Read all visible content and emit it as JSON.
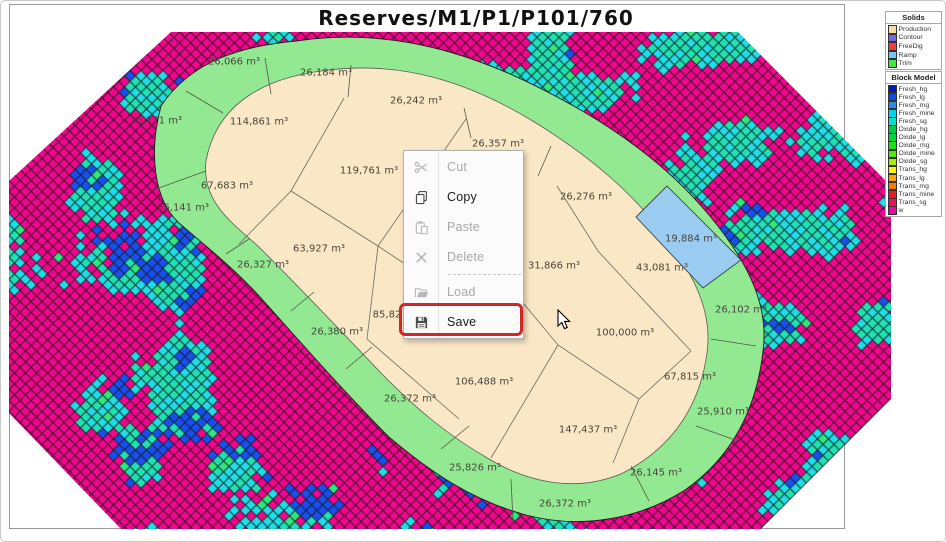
{
  "window": {
    "title": "Reserves/M1/P1/P101/760"
  },
  "map": {
    "volume_labels": [
      {
        "text": "26,066 m³",
        "x": 233,
        "y": 61
      },
      {
        "text": "26,184 m³",
        "x": 325,
        "y": 72
      },
      {
        "text": "26,242 m³",
        "x": 415,
        "y": 100
      },
      {
        "text": "26,357 m³",
        "x": 497,
        "y": 143
      },
      {
        "text": "25,771 m³",
        "x": 155,
        "y": 120
      },
      {
        "text": "114,861 m³",
        "x": 258,
        "y": 121
      },
      {
        "text": "119,761 m³",
        "x": 368,
        "y": 170
      },
      {
        "text": "67,683 m³",
        "x": 226,
        "y": 185
      },
      {
        "text": "26,141 m³",
        "x": 182,
        "y": 207
      },
      {
        "text": "63,927 m³",
        "x": 318,
        "y": 248
      },
      {
        "text": "26,327 m³",
        "x": 262,
        "y": 264
      },
      {
        "text": "26,276 m³",
        "x": 585,
        "y": 196
      },
      {
        "text": "19,884 m³",
        "x": 690,
        "y": 238
      },
      {
        "text": "31,866 m³",
        "x": 553,
        "y": 265
      },
      {
        "text": "43,081 m³",
        "x": 661,
        "y": 267
      },
      {
        "text": "26,102 m³",
        "x": 740,
        "y": 309
      },
      {
        "text": "100,000 m³",
        "x": 624,
        "y": 332
      },
      {
        "text": "85,82",
        "x": 386,
        "y": 314
      },
      {
        "text": "26,380 m³",
        "x": 336,
        "y": 331
      },
      {
        "text": "106,488 m³",
        "x": 483,
        "y": 381
      },
      {
        "text": "26,372 m³",
        "x": 409,
        "y": 398
      },
      {
        "text": "67,815 m³",
        "x": 689,
        "y": 376
      },
      {
        "text": "25,910 m³",
        "x": 722,
        "y": 411
      },
      {
        "text": "147,437 m³",
        "x": 587,
        "y": 429
      },
      {
        "text": "25,826 m³",
        "x": 474,
        "y": 467
      },
      {
        "text": "26,145 m³",
        "x": 655,
        "y": 472
      },
      {
        "text": "26,372 m³",
        "x": 564,
        "y": 503
      }
    ]
  },
  "context_menu": {
    "items": [
      {
        "label": "Cut",
        "icon": "scissors-icon",
        "enabled": false
      },
      {
        "label": "Copy",
        "icon": "copy-icon",
        "enabled": true
      },
      {
        "label": "Paste",
        "icon": "paste-icon",
        "enabled": false
      },
      {
        "label": "Delete",
        "icon": "delete-icon",
        "enabled": false
      },
      {
        "separator": true
      },
      {
        "label": "Load",
        "icon": "folder-open-icon",
        "enabled": false
      },
      {
        "label": "Save",
        "icon": "save-icon",
        "enabled": true,
        "highlighted": true
      }
    ]
  },
  "legends": {
    "solids": {
      "title": "Solids",
      "items": [
        {
          "label": "Production",
          "color": "#F5DCA5"
        },
        {
          "label": "Contour",
          "color": "#7668E0"
        },
        {
          "label": "FreeDig",
          "color": "#F04040"
        },
        {
          "label": "Ramp",
          "color": "#70C8F8"
        },
        {
          "label": "Trim",
          "color": "#44E544"
        }
      ]
    },
    "block_model": {
      "title": "Block Model",
      "items": [
        {
          "label": "Fresh_hg",
          "color": "#0018B4"
        },
        {
          "label": "Fresh_lg",
          "color": "#0E4FE1"
        },
        {
          "label": "Fresh_mg",
          "color": "#2E8CEB"
        },
        {
          "label": "Fresh_mine",
          "color": "#00D2F0"
        },
        {
          "label": "Fresh_sg",
          "color": "#00E3C8"
        },
        {
          "label": "Oxide_hg",
          "color": "#00C84B"
        },
        {
          "label": "Oxide_lg",
          "color": "#00D73C"
        },
        {
          "label": "Oxide_mg",
          "color": "#16E316"
        },
        {
          "label": "Oxide_mine",
          "color": "#52E80A"
        },
        {
          "label": "Oxide_sg",
          "color": "#A6ED00"
        },
        {
          "label": "Trans_hg",
          "color": "#FFF200"
        },
        {
          "label": "Trans_lg",
          "color": "#FFA400"
        },
        {
          "label": "Trans_mg",
          "color": "#FF7A00"
        },
        {
          "label": "Trans_mine",
          "color": "#ED1C24"
        },
        {
          "label": "Trans_sg",
          "color": "#E8145A"
        },
        {
          "label": "w",
          "color": "#F006A0"
        }
      ]
    }
  },
  "colors": {
    "pattern_magenta": "#F5048E",
    "pattern_cyan": "#1EDEE8",
    "pattern_cyan2": "#1FE2B4",
    "pattern_blue": "#184FF0",
    "pattern_green": "#2EE87C",
    "trim_green": "#92E992",
    "production_beige": "#FAE7C5",
    "ramp_blue": "#9ACBF1",
    "highlight_red": "#D32525"
  }
}
